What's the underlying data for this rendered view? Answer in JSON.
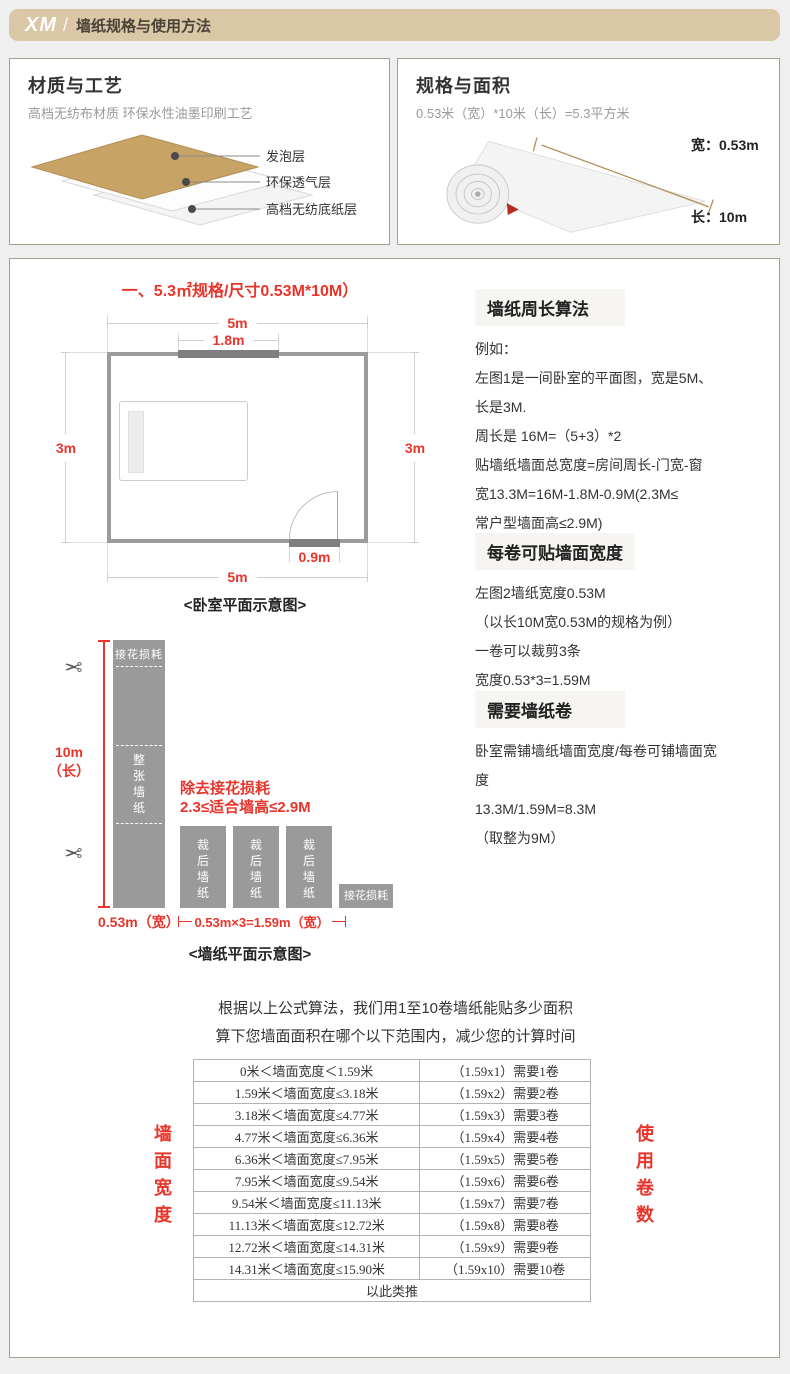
{
  "colors": {
    "accent_red": "#e8352b",
    "header_tan": "#d9c7a6",
    "panel_border": "#a79f8c",
    "wall_gray": "#9c9c9c",
    "dark_gray": "#7f7f7f",
    "strip_gray": "#9a9a9a"
  },
  "header": {
    "brand": "XM",
    "separator": "/",
    "title": "墙纸规格与使用方法"
  },
  "material_box": {
    "title": "材质与工艺",
    "subtitle": "高档无纺布材质 环保水性油墨印刷工艺",
    "layers": {
      "l1": "发泡层",
      "l2": "环保透气层",
      "l3": "高档无纺底纸层"
    }
  },
  "spec_box": {
    "title": "规格与面积",
    "subtitle": "0.53米（宽）*10米（长）=5.3平方米",
    "width_label": "宽：0.53m",
    "length_label": "长：10m"
  },
  "plan": {
    "title": "一、5.3㎡规格/尺寸0.53M*10M）",
    "dim_top": "5m",
    "dim_window": "1.8m",
    "dim_left": "3m",
    "dim_right": "3m",
    "dim_door": "0.9m",
    "dim_bottom": "5m",
    "caption": "<卧室平面示意图>"
  },
  "cut": {
    "waste_label": "接花损耗",
    "full_strip_label": "整张墙纸",
    "length_label": "10m\n（长）",
    "note": "除去接花损耗\n2.3≤适合墙高≤2.9M",
    "cut_label": "裁后墙纸",
    "width_label": "0.53m（宽）",
    "bottom_dim": "0.53m×3=1.59m（宽）",
    "caption": "<墙纸平面示意图>",
    "scissors_icon": "✂"
  },
  "sections": [
    {
      "title": "墙纸周长算法",
      "body": "例如：\n左图1是一间卧室的平面图，宽是5M、\n长是3M.\n周长是 16M=（5+3）*2\n贴墙纸墙面总宽度=房间周长-门宽-窗\n宽13.3M=16M-1.8M-0.9M(2.3M≤\n常户型墙面高≤2.9M)"
    },
    {
      "title": "每卷可贴墙面宽度",
      "body": "左图2墙纸宽度0.53M\n（以长10M宽0.53M的规格为例）\n一卷可以裁剪3条\n宽度0.53*3=1.59M"
    },
    {
      "title": "需要墙纸卷",
      "body": "卧室需铺墙纸墙面宽度/每卷可铺墙面宽\n度\n13.3M/1.59M=8.3M\n（取整为9M）"
    }
  ],
  "intro": {
    "line1": "根据以上公式算法，我们用1至10卷墙纸能贴多少面积",
    "line2": "算下您墙面面积在哪个以下范围内，减少您的计算时间"
  },
  "table": {
    "left_axis": "墙面宽度",
    "right_axis": "使用卷数",
    "rows": [
      {
        "range": "0米＜墙面宽度＜1.59米",
        "rolls": "（1.59x1）需要1卷"
      },
      {
        "range": "1.59米＜墙面宽度≤3.18米",
        "rolls": "（1.59x2）需要2卷"
      },
      {
        "range": "3.18米＜墙面宽度≤4.77米",
        "rolls": "（1.59x3）需要3卷"
      },
      {
        "range": "4.77米＜墙面宽度≤6.36米",
        "rolls": "（1.59x4）需要4卷"
      },
      {
        "range": "6.36米＜墙面宽度≤7.95米",
        "rolls": "（1.59x5）需要5卷"
      },
      {
        "range": "7.95米＜墙面宽度≤9.54米",
        "rolls": "（1.59x6）需要6卷"
      },
      {
        "range": "9.54米＜墙面宽度≤11.13米",
        "rolls": "（1.59x7）需要7卷"
      },
      {
        "range": "11.13米＜墙面宽度≤12.72米",
        "rolls": "（1.59x8）需要8卷"
      },
      {
        "range": "12.72米＜墙面宽度≤14.31米",
        "rolls": "（1.59x9）需要9卷"
      },
      {
        "range": "14.31米＜墙面宽度≤15.90米",
        "rolls": "（1.59x10）需要10卷"
      }
    ],
    "footer": "以此类推"
  }
}
